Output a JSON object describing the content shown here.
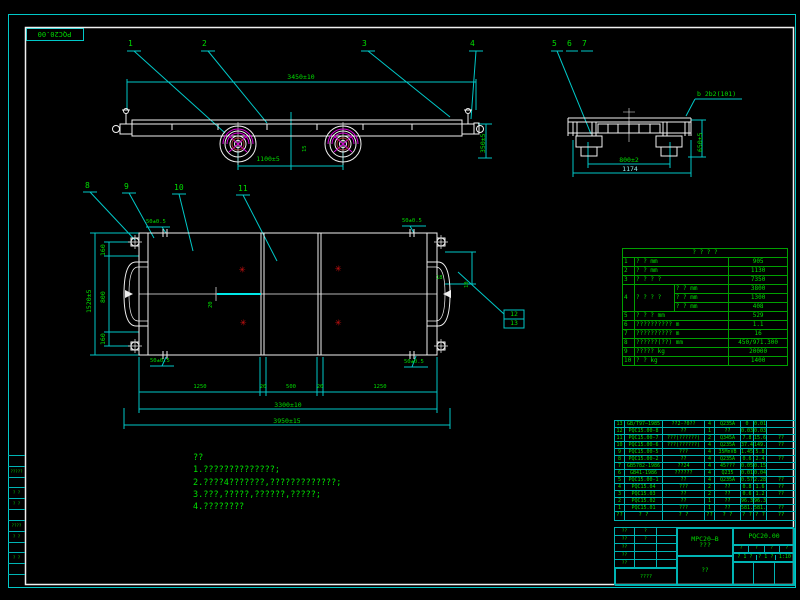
{
  "colors": {
    "frame_cyan": "#00c8c8",
    "line_white": "#f0f0f0",
    "text_green": "#00dd00",
    "magenta": "#d800d8",
    "red_mark": "#cc1111",
    "hub_red": "#a03535"
  },
  "sheet": {
    "corner_label": "PQC20.00",
    "margin_rows": [
      "",
      "?????",
      "",
      "? ?",
      "? ?",
      "",
      "????",
      "? ?",
      "",
      "? ?",
      "",
      ""
    ]
  },
  "callouts": {
    "v1": [
      "1",
      "2",
      "3",
      "4"
    ],
    "v2": [
      "5",
      "6",
      "7"
    ],
    "v3": [
      "8",
      "9",
      "10",
      "11"
    ],
    "boxed": [
      "12",
      "13"
    ]
  },
  "dims": {
    "side_top": "3450±10",
    "side_wheelbase": "1100±5",
    "side_height": "350±5",
    "side_small": "15",
    "end_width": "800±2",
    "end_overall": "1174",
    "end_height": "650±5",
    "end_weld": "b 2b2(101)",
    "plan_left_a": "160",
    "plan_left_b": "800",
    "plan_left_c": "160",
    "plan_left_total": "1520±5",
    "plan_row1": [
      "1250",
      "20",
      "500",
      "20",
      "1250"
    ],
    "plan_row2": "3300±10",
    "plan_row3": "3950±15",
    "corner_tl": "50±0.5",
    "corner_tr": "50±0.5",
    "corner_bl": "50±0.5",
    "corner_br": "50±0.5",
    "plan_center": "20",
    "plan_right_a": "18",
    "plan_right_b": "10"
  },
  "spec": {
    "title": "? ? ? ?",
    "rows": [
      {
        "no": "1",
        "label": "? ?  mm",
        "value": "905"
      },
      {
        "no": "2",
        "label": "? ?  mm",
        "value": "1130"
      },
      {
        "no": "3",
        "label": "? ? ? ?",
        "value": "7350"
      },
      {
        "no": "4",
        "label": "? ? ? ?",
        "subs": [
          {
            "label": "? ? mm",
            "value": "3800"
          },
          {
            "label": "? ? mm",
            "value": "1300"
          },
          {
            "label": "? ? mm",
            "value": "408"
          }
        ]
      },
      {
        "no": "5",
        "label": "? ? ?  mm",
        "value": "529"
      },
      {
        "no": "6",
        "label": "??????????  m",
        "value": "1.1"
      },
      {
        "no": "7",
        "label": "??????????  m",
        "value": "16"
      },
      {
        "no": "8",
        "label": "??????(??)  mm",
        "value": "450/971.300"
      },
      {
        "no": "9",
        "label": "?????  kg",
        "value": "20000"
      },
      {
        "no": "10",
        "label": "? ?  kg",
        "value": "1400"
      }
    ]
  },
  "notes": {
    "lines": [
      "??",
      "1.??????????????;",
      "2.????4???????,?????????????;",
      "3.???,?????,??????,?????;",
      "4.????????"
    ]
  },
  "bom": {
    "header": [
      "??",
      "? ?",
      "? ?",
      "??",
      "? ?",
      "? ?",
      "? ?",
      "??"
    ],
    "rows": [
      [
        "13",
        "GB/T97—1985",
        "??2-?0??",
        "4",
        "Q235A",
        "0",
        "0.01",
        ""
      ],
      [
        "12",
        "PQC15.00-8",
        "??",
        "1",
        "??",
        "0.03",
        "0.03",
        ""
      ],
      [
        "11",
        "PQC15.00-7",
        "???(??????)",
        "2",
        "Q345A",
        "7.8",
        "15.6",
        "??"
      ],
      [
        "10",
        "PQC15.00-6",
        "???(??????)",
        "4",
        "Q235A",
        "37.4",
        "149.7",
        "??"
      ],
      [
        "9",
        "PQC15.00-5",
        "???",
        "4",
        "35MnVB",
        "1.45",
        "5.8",
        ""
      ],
      [
        "8",
        "PQC15.00-2",
        "??",
        "4",
        "Q235A",
        "0.6",
        "2.4",
        "??"
      ],
      [
        "7",
        "GB5782-1986",
        "??24",
        "4",
        "45???",
        "0.05",
        "0.15",
        ""
      ],
      [
        "6",
        "GB41-1986",
        "??????",
        "4",
        "Q235",
        "0.01",
        "0.04",
        ""
      ],
      [
        "5",
        "PQC15.00-1",
        "??",
        "4",
        "Q235A",
        "0.57",
        "2.28",
        "??"
      ],
      [
        "4",
        "PQC15.04",
        "???",
        "2",
        "??",
        "0.8",
        "1.6",
        "??"
      ],
      [
        "3",
        "PQC15.03",
        "??",
        "2",
        "??",
        "0.6",
        "1.2",
        "??"
      ],
      [
        "2",
        "PQC15.02",
        "??",
        "1",
        "??",
        "96.3",
        "96.3",
        ""
      ],
      [
        "1",
        "PQC15.01",
        "???",
        "1",
        "??",
        "581.3",
        "581.3",
        "??"
      ]
    ]
  },
  "title_block": {
    "sig_rows": [
      {
        "a": "??",
        "b": "?",
        "c": ""
      },
      {
        "a": "??",
        "b": "?",
        "c": ""
      },
      {
        "a": "??",
        "b": "",
        "c": ""
      },
      {
        "a": "??",
        "b": "",
        "c": ""
      },
      {
        "a": "??",
        "b": "",
        "c": ""
      }
    ],
    "sig_bottom": "????",
    "drawing_code": "MPC20—B",
    "drawing_name": "???",
    "company": "??",
    "part_code": "PQC20.00",
    "small_cells": [
      "?",
      "?",
      "?",
      "?"
    ],
    "sheet": "? 1 ?",
    "page": "? 1 ?",
    "scale": "1:10"
  }
}
